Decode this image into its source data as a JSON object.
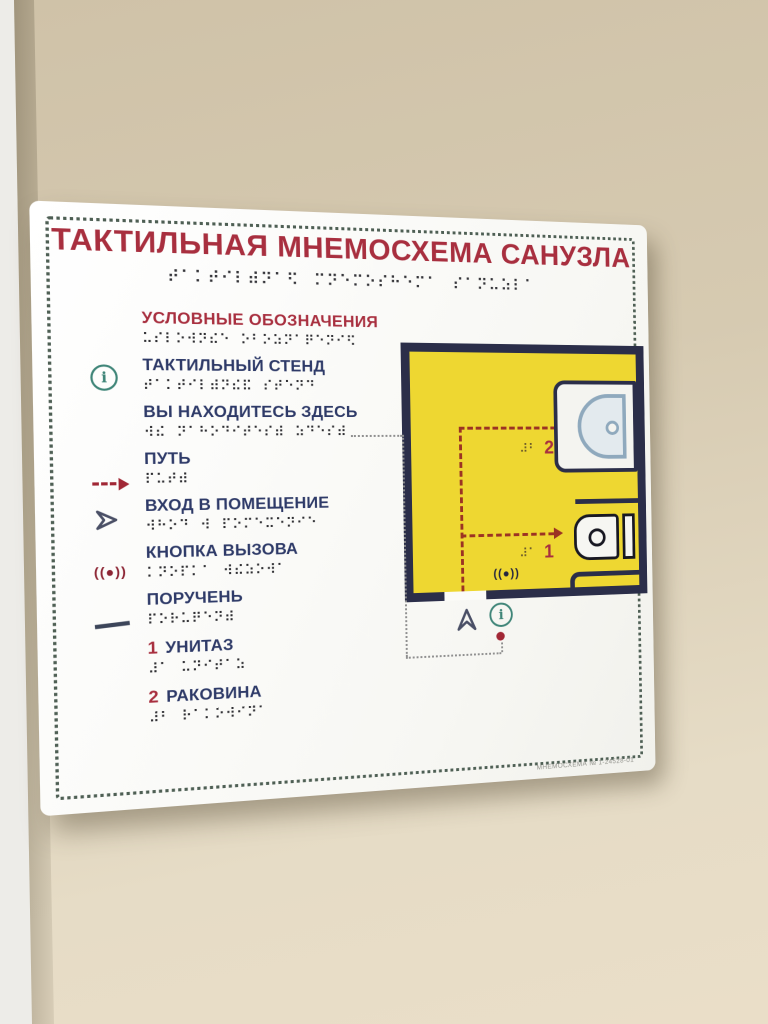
{
  "sign": {
    "title": "ТАКТИЛЬНАЯ МНЕМОСХЕМА САНУЗЛА",
    "title_braille": "⠞⠁⠅⠞⠊⠇⠾⠝⠁⠫ ⠍⠝⠑⠍⠕⠎⠓⠑⠍⠁ ⠎⠁⠝⠥⠵⠇⠁",
    "serial": "МНЕМОСХЕМА № 1-24528-01",
    "legend": {
      "header": "УСЛОВНЫЕ ОБОЗНАЧЕНИЯ",
      "header_braille": "⠥⠎⠇⠕⠺⠝⠮⠑ ⠕⠃⠕⠵⠝⠁⠟⠑⠝⠊⠫",
      "info_icon_glyph": "i",
      "items": [
        {
          "icon": "info-icon",
          "label": "ТАКТИЛЬНЫЙ СТЕНД",
          "braille": "⠞⠁⠅⠞⠊⠇⠾⠝⠮⠯ ⠎⠞⠑⠝⠙"
        },
        {
          "icon": "you-are-here-dot-icon",
          "label": "ВЫ НАХОДИТЕСЬ ЗДЕСЬ",
          "braille": "⠺⠮ ⠝⠁⠓⠕⠙⠊⠞⠑⠎⠾ ⠵⠙⠑⠎⠾"
        },
        {
          "icon": "path-dashed-arrow-icon",
          "label": "ПУТЬ",
          "braille": "⠏⠥⠞⠾"
        },
        {
          "icon": "entrance-chevron-icon",
          "label": "ВХОД В ПОМЕЩЕНИЕ",
          "braille": "⠺⠓⠕⠙ ⠺ ⠏⠕⠍⠑⠭⠑⠝⠊⠑"
        },
        {
          "icon": "call-button-icon",
          "label": "КНОПКА ВЫЗОВА",
          "braille": "⠅⠝⠕⠏⠅⠁ ⠺⠮⠵⠕⠺⠁",
          "icon_text": "((●))"
        },
        {
          "icon": "handrail-line-icon",
          "label": "ПОРУЧЕНЬ",
          "braille": "⠏⠕⠗⠥⠟⠑⠝⠾"
        },
        {
          "number": "1",
          "label": "УНИТАЗ",
          "braille": "⠼⠁ ⠥⠝⠊⠞⠁⠵"
        },
        {
          "number": "2",
          "label": "РАКОВИНА",
          "braille": "⠼⠃ ⠗⠁⠅⠕⠺⠊⠝⠁"
        }
      ]
    },
    "map": {
      "sink_label": {
        "number": "2",
        "braille": "⠼⠃"
      },
      "toilet_label": {
        "number": "1",
        "braille": "⠼⠁"
      },
      "call_button_text": "((●))",
      "info_icon_glyph": "i"
    },
    "colors": {
      "heading_red": "#a82f3f",
      "text_navy": "#2e3a68",
      "map_yellow": "#eed731",
      "map_wall_navy": "#2b2e49",
      "dotted_border_green": "#4e5f54",
      "path_red": "#9c3323",
      "info_teal": "#3f8578",
      "marker_red": "#a12735"
    }
  }
}
